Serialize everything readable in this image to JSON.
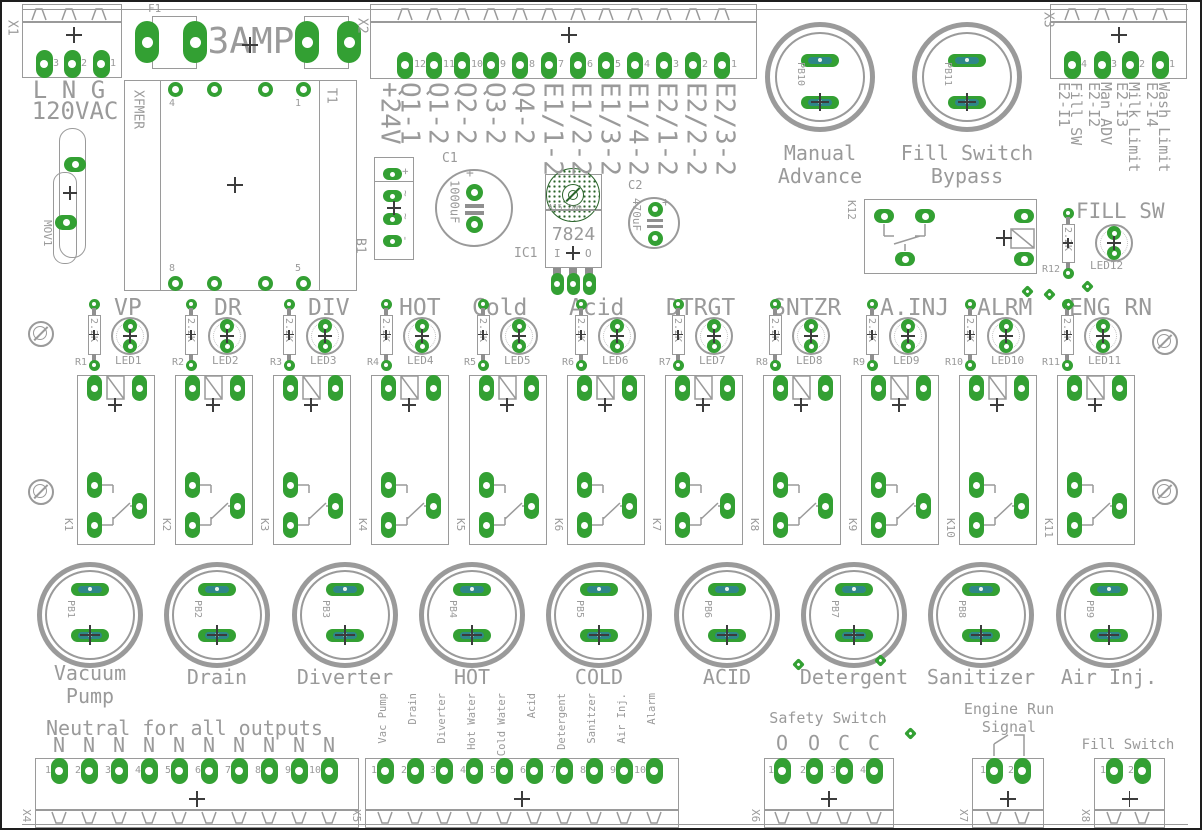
{
  "x1": {
    "ref": "X1",
    "pin_numbers": [
      "3",
      "2",
      "1"
    ],
    "pin_labels": [
      "L",
      "N",
      "G"
    ],
    "caption": "120VAC"
  },
  "fuse": {
    "ref": "F1",
    "value": "3AMP"
  },
  "transformer": {
    "ref": "XFMER",
    "part": "T1",
    "pin_top_left": "4",
    "pin_top_right": "1",
    "pin_bottom_left": "8",
    "pin_bottom_right": "5"
  },
  "mov": {
    "ref": "MOV1"
  },
  "bridge": {
    "ref": "B1",
    "pin_labels": [
      "+",
      "~",
      "~",
      "-"
    ]
  },
  "cap1": {
    "ref": "C1",
    "value": "1000uF",
    "polarity": "+"
  },
  "regulator": {
    "ref": "IC1",
    "value": "7824",
    "pin_in": "I",
    "pin_out": "O",
    "note": "A15.2mm"
  },
  "cap2": {
    "ref": "C2",
    "value": "470uF",
    "polarity": "+"
  },
  "x2": {
    "ref": "X2",
    "pin_numbers": [
      "12",
      "11",
      "10",
      "9",
      "8",
      "7",
      "6",
      "5",
      "4",
      "3",
      "2",
      "1"
    ],
    "signals": [
      "+24V",
      "Q1-1",
      "Q1-2",
      "Q2-2",
      "Q3-2",
      "Q4-2",
      "E1/1-2",
      "E1/2-2",
      "E1/3-2",
      "E1/4-2",
      "E2/1-2",
      "E2/2-2",
      "E2/3-2"
    ]
  },
  "x3": {
    "ref": "X3",
    "pin_numbers": [
      "4",
      "3",
      "2",
      "1"
    ],
    "signals": [
      {
        "id": "E2-I1",
        "name": "Fill SW"
      },
      {
        "id": "E2-I2",
        "name": "Man ADV"
      },
      {
        "id": "E2-I3",
        "name": "Milk Limit"
      },
      {
        "id": "E2-I4",
        "name": "Wash Limit"
      }
    ]
  },
  "top_buttons": [
    {
      "ref": "PB10",
      "label_lines": [
        "Manual",
        "Advance"
      ]
    },
    {
      "ref": "PB11",
      "label_lines": [
        "Fill Switch",
        "Bypass"
      ]
    }
  ],
  "fill_sw": {
    "title": "FILL SW",
    "relay_ref": "K12",
    "resistor_ref": "R12",
    "resistor_value": "2.2K",
    "led_ref": "LED12"
  },
  "indicators": [
    {
      "label": "VP",
      "resistor_ref": "R1",
      "resistor_value": "2.2K",
      "led_ref": "LED1"
    },
    {
      "label": "DR",
      "resistor_ref": "R2",
      "resistor_value": "2.2K",
      "led_ref": "LED2"
    },
    {
      "label": "DIV",
      "resistor_ref": "R3",
      "resistor_value": "2.2K",
      "led_ref": "LED3"
    },
    {
      "label": "HOT",
      "resistor_ref": "R4",
      "resistor_value": "2.2K",
      "led_ref": "LED4"
    },
    {
      "label": "Cold",
      "resistor_ref": "R5",
      "resistor_value": "2.2K",
      "led_ref": "LED5"
    },
    {
      "label": "Acid",
      "resistor_ref": "R6",
      "resistor_value": "2.2K",
      "led_ref": "LED6"
    },
    {
      "label": "DTRGT",
      "resistor_ref": "R7",
      "resistor_value": "2.2K",
      "led_ref": "LED7"
    },
    {
      "label": "SNTZR",
      "resistor_ref": "R8",
      "resistor_value": "2.2K",
      "led_ref": "LED8"
    },
    {
      "label": "A.INJ",
      "resistor_ref": "R9",
      "resistor_value": "2.2K",
      "led_ref": "LED9"
    },
    {
      "label": "ALRM",
      "resistor_ref": "R10",
      "resistor_value": "2.2K",
      "led_ref": "LED10"
    },
    {
      "label": "ENG RN",
      "resistor_ref": "R11",
      "resistor_value": "2.2K",
      "led_ref": "LED11"
    }
  ],
  "relay_refs": [
    "K1",
    "K2",
    "K3",
    "K4",
    "K5",
    "K6",
    "K7",
    "K8",
    "K9",
    "K10",
    "K11"
  ],
  "buttons": [
    {
      "ref": "PB1",
      "label_lines": [
        "Vacuum",
        "Pump"
      ]
    },
    {
      "ref": "PB2",
      "label_lines": [
        "Drain"
      ]
    },
    {
      "ref": "PB3",
      "label_lines": [
        "Diverter"
      ]
    },
    {
      "ref": "PB4",
      "label_lines": [
        "HOT"
      ]
    },
    {
      "ref": "PB5",
      "label_lines": [
        "COLD"
      ]
    },
    {
      "ref": "PB6",
      "label_lines": [
        "ACID"
      ]
    },
    {
      "ref": "PB7",
      "label_lines": [
        "Detergent"
      ]
    },
    {
      "ref": "PB8",
      "label_lines": [
        "Sanitizer"
      ]
    },
    {
      "ref": "PB9",
      "label_lines": [
        "Air Inj."
      ]
    }
  ],
  "x4": {
    "ref": "X4",
    "title": "Neutral for all outputs",
    "wire_labels": [
      "N",
      "N",
      "N",
      "N",
      "N",
      "N",
      "N",
      "N",
      "N",
      "N"
    ],
    "pin_numbers": [
      "1",
      "2",
      "3",
      "4",
      "5",
      "6",
      "7",
      "8",
      "9",
      "10"
    ]
  },
  "x5": {
    "ref": "X5",
    "signals": [
      "Vac Pump",
      "Drain",
      "Diverter",
      "Hot Water",
      "Cold Water",
      "Acid",
      "Detergent",
      "Sanitzer",
      "Air Inj.",
      "Alarm"
    ],
    "pin_numbers": [
      "1",
      "2",
      "3",
      "4",
      "5",
      "6",
      "7",
      "8",
      "9",
      "10"
    ]
  },
  "x6": {
    "ref": "X6",
    "title": "Safety Switch",
    "wire_labels": [
      "O",
      "O",
      "C",
      "C"
    ],
    "pin_numbers": [
      "1",
      "2",
      "3",
      "4"
    ]
  },
  "x7": {
    "ref": "X7",
    "title_lines": [
      "Engine Run",
      "Signal"
    ],
    "pin_numbers": [
      "1",
      "2"
    ]
  },
  "x8": {
    "ref": "X8",
    "title": "Fill Switch",
    "pin_numbers": [
      "1",
      "2"
    ]
  }
}
